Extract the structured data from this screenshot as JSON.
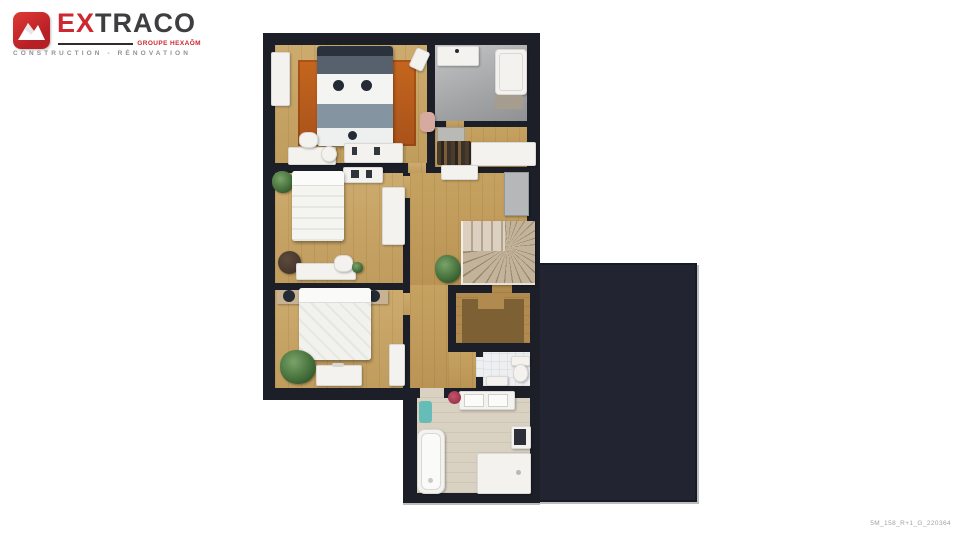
{
  "brand": {
    "name_ex": "EX",
    "name_traco": "TRACO",
    "group": "GROUPE HEXAÔM",
    "tagline": "CONSTRUCTION - RÉNOVATION",
    "colors": {
      "red": "#cf2730",
      "dark_gray": "#3e3e40",
      "tagline_gray": "#8c9297"
    }
  },
  "footer": {
    "reference": "5M_158_R+1_G_220364"
  },
  "floor_plan": {
    "type": "3d-top-down-floor-plan",
    "level": "R+1",
    "colors": {
      "wall": "#1c1f28",
      "void_area": "#222531",
      "bedroom_wood": "#c8a567",
      "hallway_wood": "#c29e5c",
      "bathroom_top_tile": "#a6a7a9",
      "dressing_wood": "#b08a4e",
      "dressing_wood_dark": "#7d6134",
      "wc_tile": "#edeff1",
      "bathroom_bottom_wood": "#d9d1c2",
      "rug_orange": "#b85c1f",
      "bed_blanket_gray": "#8494a1",
      "plant_green": "#46713c",
      "mat_teal": "#66bdb8",
      "flowers_red": "#a83148"
    },
    "rooms": [
      {
        "name": "bedroom-1",
        "furniture": [
          "double-bed",
          "orange-rug",
          "wardrobe",
          "desk",
          "desk-chair",
          "dresser",
          "floor-lamp",
          "armchair",
          "vase"
        ]
      },
      {
        "name": "bathroom-top",
        "furniture": [
          "washbasin",
          "bathtub",
          "bath-mat"
        ]
      },
      {
        "name": "closet",
        "furniture": [
          "hanging-clothes",
          "dresser",
          "storage-box"
        ]
      },
      {
        "name": "bedroom-2",
        "furniture": [
          "double-bed",
          "wardrobe",
          "desk",
          "desk-chair",
          "beanbag",
          "plant",
          "shelf"
        ]
      },
      {
        "name": "bedroom-3",
        "furniture": [
          "double-bed",
          "nightstand-left",
          "nightstand-right",
          "bench",
          "plant",
          "wardrobe"
        ]
      },
      {
        "name": "landing-hallway",
        "furniture": [
          "winder-staircase",
          "plant",
          "cabinet",
          "shelf"
        ]
      },
      {
        "name": "dressing",
        "furniture": []
      },
      {
        "name": "wc",
        "furniture": [
          "toilet",
          "shelf"
        ]
      },
      {
        "name": "bathroom-bottom",
        "furniture": [
          "bathtub",
          "double-washbasin",
          "shower",
          "washing-machine",
          "bath-mat",
          "flowers"
        ]
      }
    ]
  }
}
